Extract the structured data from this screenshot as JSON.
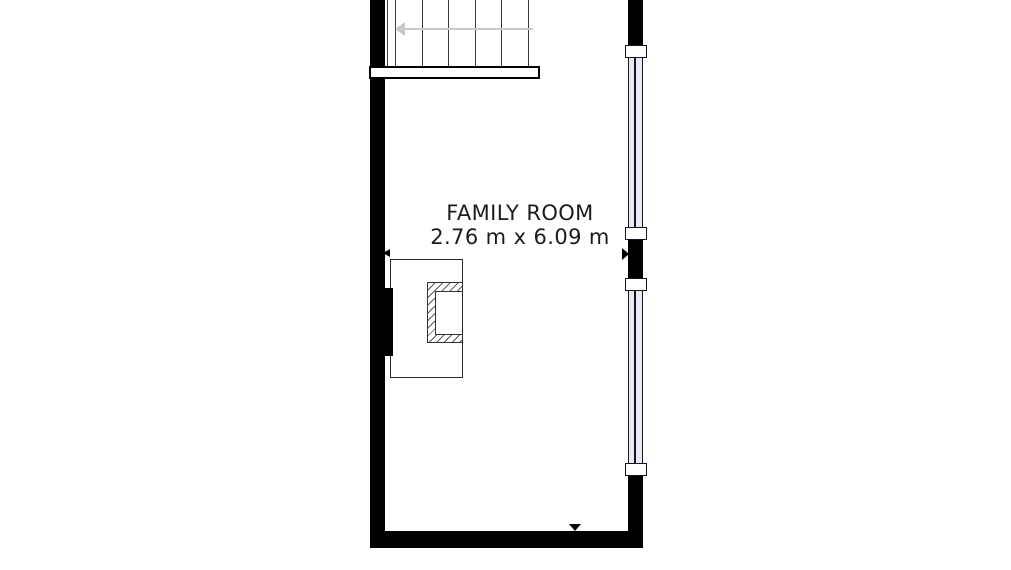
{
  "floorplan": {
    "room": {
      "name": "FAMILY ROOM",
      "dimensions": "2.76 m x 6.09 m"
    },
    "colors": {
      "wall": "#000000",
      "window_glass": "#e9e9f3",
      "stair_arrow": "#c8c8c8",
      "hatch_line": "#5a5a5a",
      "label_text": "#1b1b1b"
    },
    "icons": [
      "stair-direction-arrow-icon",
      "entry-marker-left-icon",
      "entry-marker-right-icon",
      "entry-marker-down-icon"
    ],
    "features": {
      "stair_tread_lines": 6,
      "windows": 2
    }
  }
}
